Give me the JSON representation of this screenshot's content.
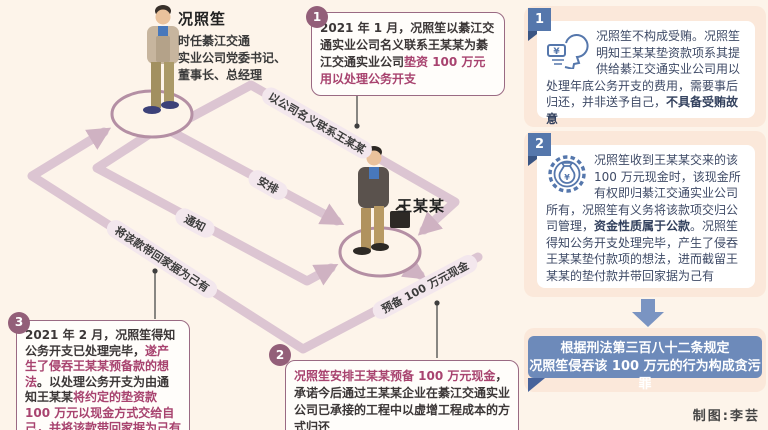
{
  "actors": {
    "kuang": {
      "name": "况照笙",
      "title_lines": [
        "时任綦江交通",
        "实业公司党委书记、",
        "董事长、总经理"
      ]
    },
    "wang": {
      "name": "王某某"
    }
  },
  "flow": {
    "contact": "以公司名义联系王某某",
    "arrange": "安排",
    "notify": "通知",
    "prepare": "预备 100 万元现金",
    "take_home": "将该款带回家据为己有"
  },
  "callouts": [
    {
      "num": "1",
      "segments": [
        {
          "t": "2021 年 1 月，况照笙以綦江交通实业公司名义联系王某某为綦江交通实业公司",
          "b": false
        },
        {
          "t": "垫资 100 万元用以处理公务开支",
          "b": true
        }
      ]
    },
    {
      "num": "2",
      "segments": [
        {
          "t": "况照笙安排王某某预备 100 万元现金",
          "b": true
        },
        {
          "t": "，承诺今后通过王某某企业在綦江交通实业公司已承接的工程中以虚增工程成本的方式归还",
          "b": false
        }
      ]
    },
    {
      "num": "3",
      "segments": [
        {
          "t": "2021 年 2 月，况照笙得知公务开支已处理完毕，",
          "b": false
        },
        {
          "t": "遂产生了侵吞王某某预备款的想法",
          "b": true
        },
        {
          "t": "。以处理公务开支为由通知王某某",
          "b": false
        },
        {
          "t": "将约定的垫资款 100 万元以现金方式交给自己，并将该款带回家据为己有",
          "b": true
        }
      ]
    }
  ],
  "analysis": [
    {
      "num": "1",
      "icon": "money-thought-icon",
      "segments": [
        {
          "t": "况照笙不构成受贿。况照笙明知王某某垫资款项系其提供给綦江交通实业公司用以处理年底公务开支的费用，需要事后归还，并非送予自己，",
          "b": false
        },
        {
          "t": "不具备受贿故意",
          "b": true
        }
      ]
    },
    {
      "num": "2",
      "icon": "public-funds-icon",
      "segments": [
        {
          "t": "况照笙收到王某某交来的该 100 万元现金时，该现金所有权即归綦江交通实业公司所有，况照笙有义务将该款项交归公司管理，",
          "b": false
        },
        {
          "t": "资金性质属于公款",
          "b": true
        },
        {
          "t": "。况照笙得知公务开支处理完毕，产生了侵吞王某某垫付款项的想法，进而截留王某某的垫付款并带回家据为己有",
          "b": false
        }
      ]
    }
  ],
  "conclusion": {
    "lines": [
      "根据刑法第三百八十二条规定",
      "况照笙侵吞该 100 万元的行为构成贪污罪"
    ]
  },
  "credit": "制图:李芸",
  "colors": {
    "background": "#fdf4ea",
    "flow_path": "#dcc5d2",
    "plum_accent": "#935f79",
    "highlight_text": "#a8436f",
    "panel_peach": "#fbe8da",
    "blue_accent": "#5577ac",
    "conclusion_bg": "#6d8aba",
    "text_dark": "#3c3737",
    "text_navy": "#3e4a66"
  }
}
